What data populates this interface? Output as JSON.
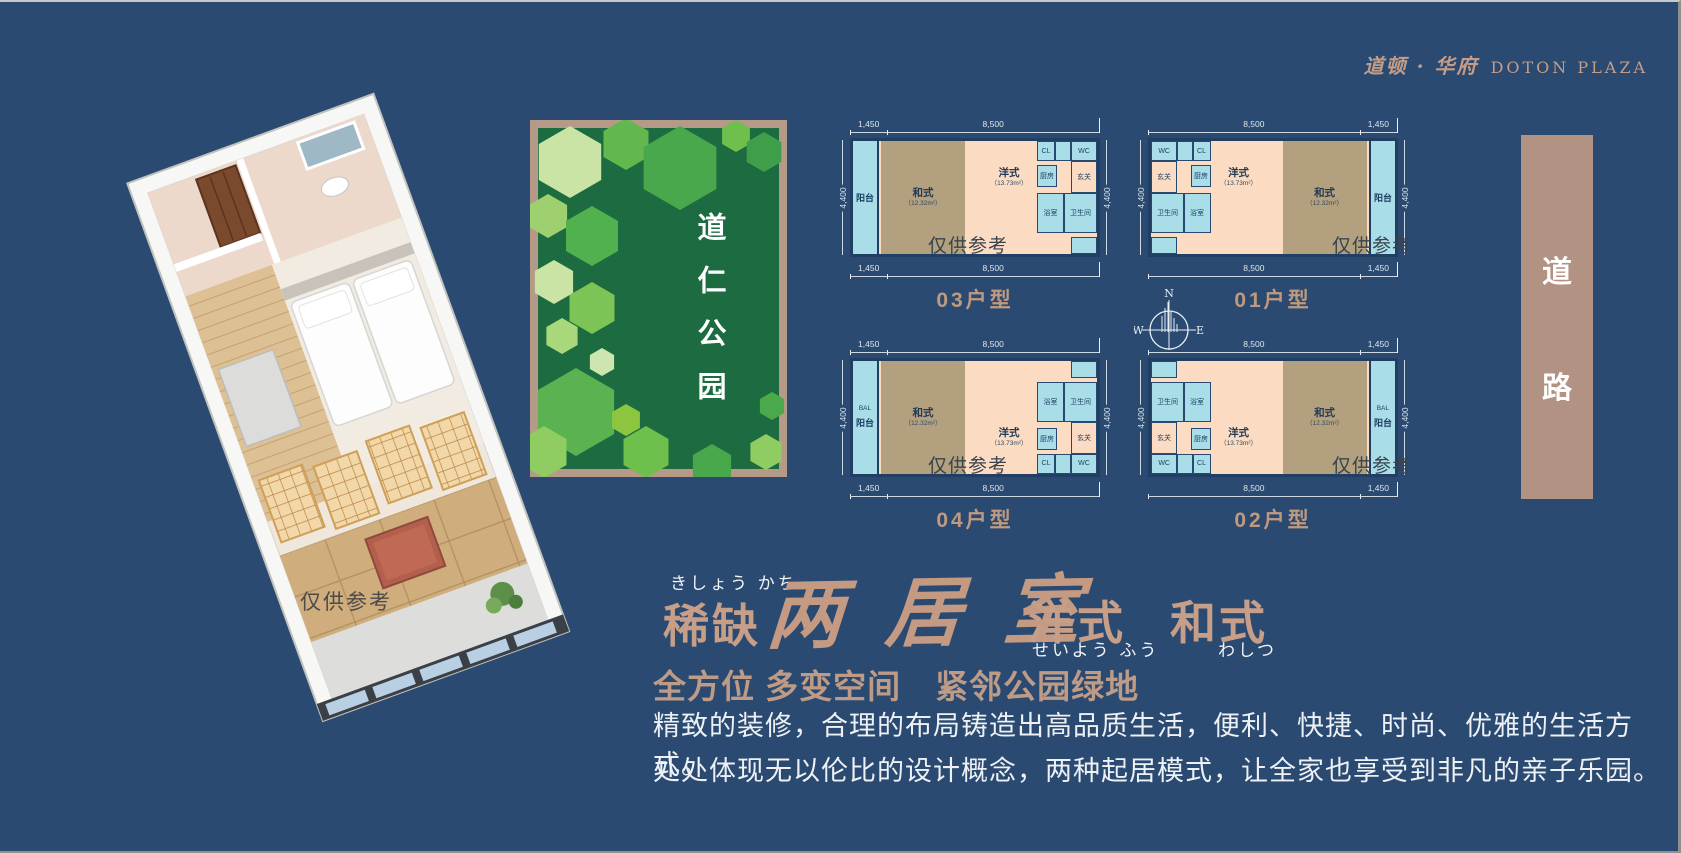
{
  "logo": {
    "cn": "道顿 · 华府",
    "en": "DOTON PLAZA"
  },
  "render3d": {
    "watermark": "仅供参考"
  },
  "park": {
    "name": "道仁公园"
  },
  "road": {
    "char_top": "道",
    "char_bottom": "路"
  },
  "compass": {
    "n": "N",
    "e": "E",
    "s": "S",
    "w": "W"
  },
  "plans": {
    "watermark": "仅供参考",
    "side_dim": "4,400",
    "rooms": {
      "balcony": "阳台",
      "bal": "BAL",
      "washitsu": "和式",
      "washitsu_area": "（12.32m²）",
      "yoshiki": "洋式",
      "yoshiki_area": "（13.73m²）",
      "kitchen": "厨房",
      "bath": "浴室",
      "toilet": "卫生间",
      "entry": "玄关",
      "wc": "WC",
      "cl": "CL"
    },
    "items": [
      {
        "label": "03户型",
        "dims": [
          "1,450",
          "8,500"
        ]
      },
      {
        "label": "01户型",
        "dims": [
          "8,500",
          "1,450"
        ]
      },
      {
        "label": "04户型",
        "dims": [
          "1,450",
          "8,500"
        ]
      },
      {
        "label": "02户型",
        "dims": [
          "8,500",
          "1,450"
        ]
      }
    ]
  },
  "headline": {
    "furigana_left": "きしょう かち",
    "word_left": "稀缺",
    "brush": "两 居 室",
    "word_mid": "洋式",
    "furigana_mid": "せいよう ふう",
    "word_right": "和式",
    "furigana_right": "わしつ",
    "subtitle": "全方位 多变空间　紧邻公园绿地"
  },
  "body": {
    "line1": "精致的装修，合理的布局铸造出高品质生活，便利、快捷、时尚、优雅的生活方式。",
    "line2": "处处体现无以伦比的设计概念，两种起居模式，让全家也享受到非凡的亲子乐园。"
  }
}
